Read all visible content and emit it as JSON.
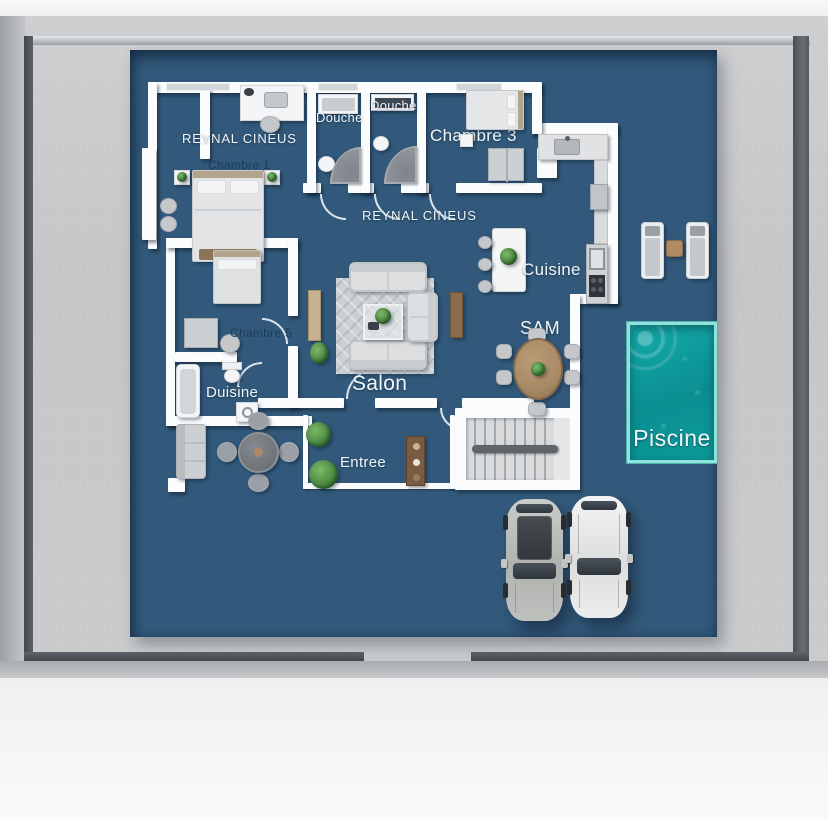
{
  "plan": {
    "watermark_top": "REYNAL CINEUS",
    "watermark_center": "REYNAL CINEUS",
    "rooms": {
      "chambre1": "Chambre 1",
      "douche1": "Douche",
      "douche2": "Douche",
      "chambre3": "Chambre 3",
      "cuisine": "Cuisine",
      "sam": "SAM",
      "chambre5": "Chambre 5",
      "duisine": "Duisine",
      "salon": "Salon",
      "entree": "Entree",
      "piscine": "Piscine"
    }
  },
  "colors": {
    "floor": "#32597b",
    "wall": "#fbfcfd",
    "concrete": "#c6c8ca",
    "frame": "#53585e",
    "pool": "#0da0a1",
    "pool_border": "#8fe3dc",
    "label_light": "#f1f6f9",
    "label_dark": "#1d3d5c",
    "wood": "#a98a66",
    "plant_green": "#4d8a43"
  }
}
